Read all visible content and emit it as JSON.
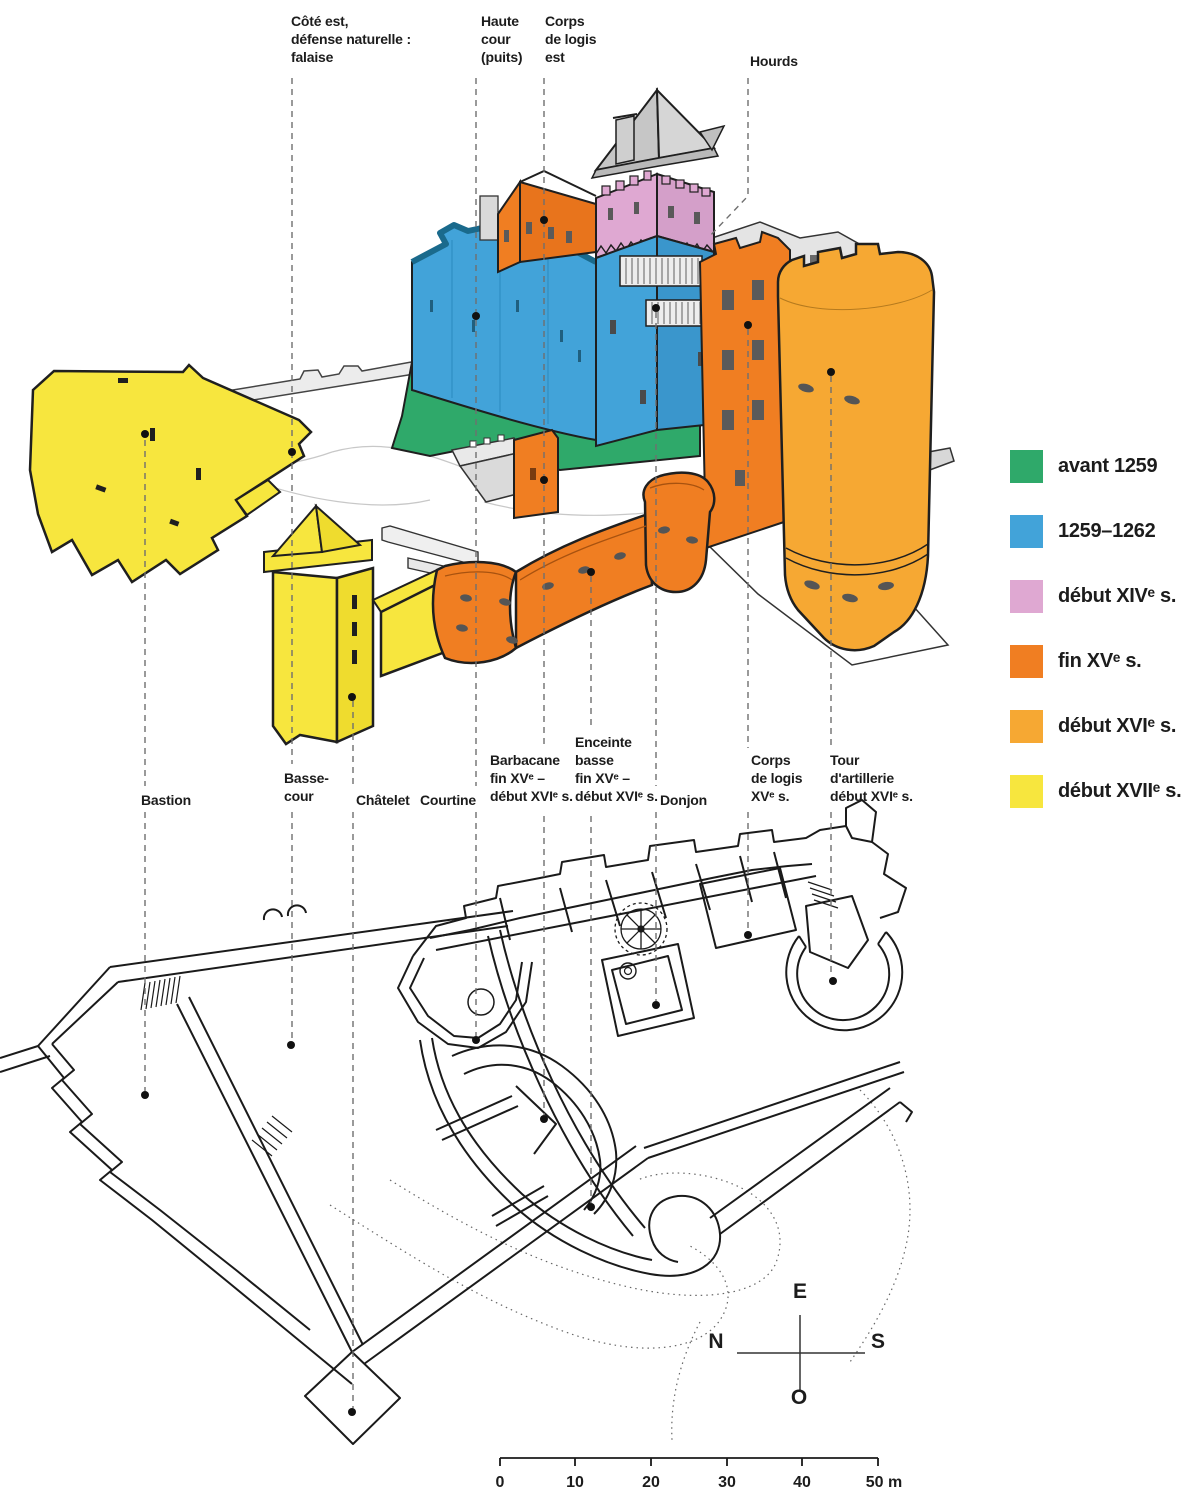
{
  "diagram_title": "Phases de construction du château (vue axonométrique et plan)",
  "colors": {
    "green": "#2FA96A",
    "blue": "#42A3D9",
    "pink": "#DFA8D2",
    "orange": "#F07E22",
    "amber": "#F6A833",
    "yellow": "#F7E63E",
    "outline": "#1f1f1f"
  },
  "legend": {
    "items": [
      {
        "key": "green",
        "label": "avant 1259"
      },
      {
        "key": "blue",
        "label": "1259–1262"
      },
      {
        "key": "pink",
        "label": "début XIVᵉ s."
      },
      {
        "key": "orange",
        "label": "fin XVᵉ s."
      },
      {
        "key": "amber",
        "label": "début XVIᵉ s."
      },
      {
        "key": "yellow",
        "label": "début XVIIᵉ s."
      }
    ]
  },
  "labels_top": [
    {
      "id": "cote-est",
      "text": "Côté est,\ndéfense naturelle :\nfalaise"
    },
    {
      "id": "haute-cour",
      "text": "Haute\ncour\n(puits)"
    },
    {
      "id": "corps-logis-est",
      "text": "Corps\nde logis\nest"
    },
    {
      "id": "hourds",
      "text": "Hourds"
    }
  ],
  "labels_middle": [
    {
      "id": "bastion",
      "text": "Bastion"
    },
    {
      "id": "basse-cour",
      "text": "Basse-\ncour"
    },
    {
      "id": "chatelet",
      "text": "Châtelet"
    },
    {
      "id": "courtine",
      "text": "Courtine"
    },
    {
      "id": "barbacane",
      "text": "Barbacane\nfin XVᵉ –\ndébut XVIᵉ s."
    },
    {
      "id": "enceinte-basse",
      "text": "Enceinte\nbasse\nfin XVᵉ –\ndébut XVIᵉ s."
    },
    {
      "id": "donjon",
      "text": "Donjon"
    },
    {
      "id": "corps-logis",
      "text": "Corps\nde logis\nXVᵉ s."
    },
    {
      "id": "tour-artillerie",
      "text": "Tour\nd'artillerie\ndébut XVIᵉ s."
    }
  ],
  "compass": {
    "east": "E",
    "north": "N",
    "south": "S",
    "west": "O"
  },
  "scale_bar": {
    "ticks": [
      "0",
      "10",
      "20",
      "30",
      "40",
      "50 m"
    ]
  }
}
